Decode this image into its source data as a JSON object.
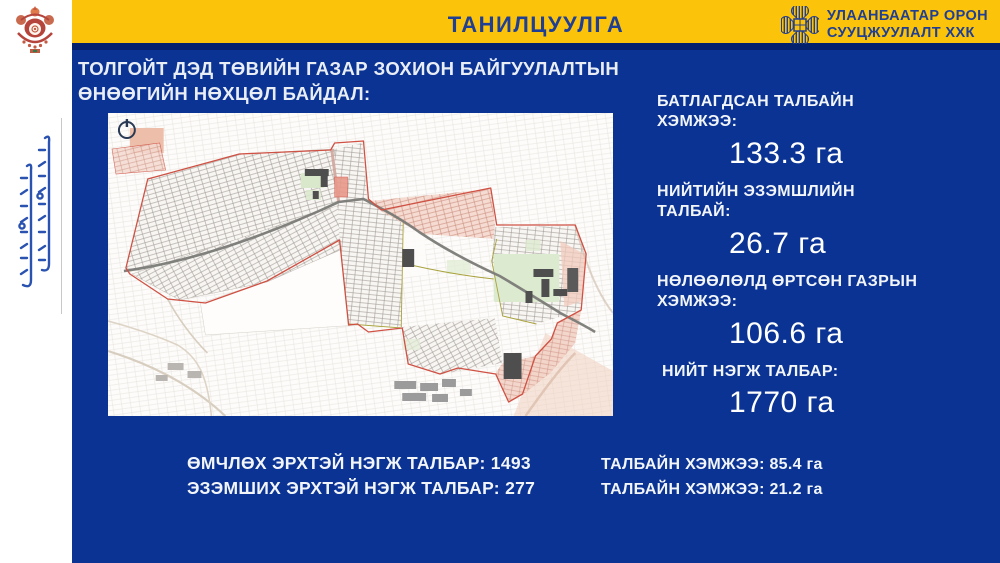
{
  "header": {
    "title": "ТАНИЛЦУУЛГА",
    "logo_line1": "УЛААНБААТАР ОРОН",
    "logo_line2": "СУУЦЖУУЛАЛТ ХХК"
  },
  "main": {
    "heading_line1": "ТОЛГОЙТ ДЭД ТӨВИЙН ГАЗАР ЗОХИОН БАЙГУУЛАЛТЫН",
    "heading_line2": "ӨНӨӨГИЙН НӨХЦӨЛ БАЙДАЛ:",
    "stats": [
      {
        "label": "БАТЛАГДСАН ТАЛБАЙН ХЭМЖЭЭ:",
        "value": "133.3 га"
      },
      {
        "label": "НИЙТИЙН ЭЗЭМШЛИЙН ТАЛБАЙ:",
        "value": "26.7 га"
      },
      {
        "label": "НӨЛӨӨЛӨЛД ӨРТСӨН  ГАЗРЫН ХЭМЖЭЭ:",
        "value": "106.6 га"
      },
      {
        "label": "НИЙТ НЭГЖ ТАЛБАР:",
        "value": "1770 га"
      }
    ],
    "footer_left": [
      "ӨМЧЛӨХ ЭРХТЭЙ НЭГЖ ТАЛБАР: 1493",
      "ЭЗЭМШИХ ЭРХТЭЙ НЭГЖ ТАЛБАР: 277"
    ],
    "footer_right": [
      "ТАЛБАЙН ХЭМЖЭЭ: 85.4 га",
      "ТАЛБАЙН ХЭМЖЭЭ: 21.2 га"
    ]
  },
  "icons": {
    "crest": "ulaanbaatar-crest-emblem",
    "logo_mark": "ub-housing-knot-logo",
    "map_corner": "compass-power-icon",
    "left_script": "vertical-mongolian-script"
  },
  "colors": {
    "background_blue": "#0a3394",
    "band_yellow": "#fcc30b",
    "band_navy_edge": "#04216d",
    "title_blue": "#1f3f94",
    "text_white": "#f2f5fa",
    "map_boundary_red": "#cf5144",
    "script_blue": "#2a52b0"
  }
}
